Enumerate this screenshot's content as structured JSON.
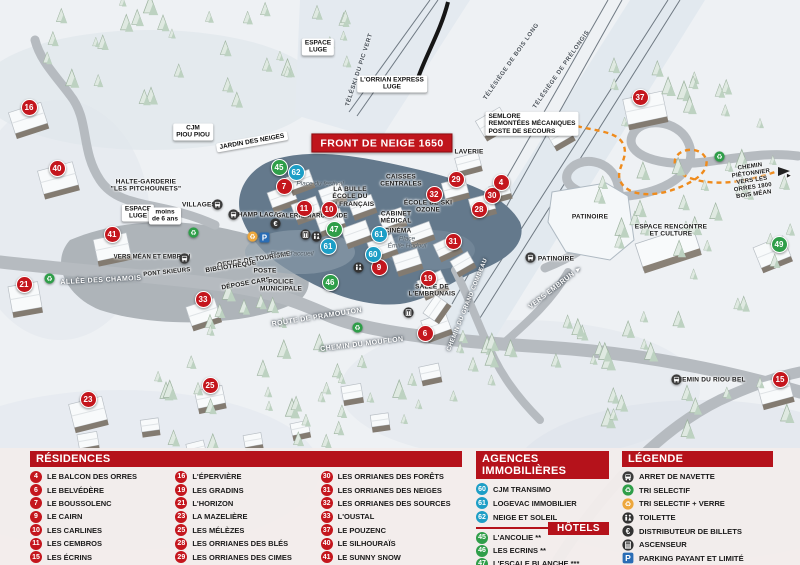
{
  "title": "FRONT DE NEIGE 1650",
  "colors": {
    "residence": "#c4161d",
    "agency": "#1d9ec6",
    "hotel": "#2f9e49",
    "header_red": "#b5121b",
    "parking_blue": "#2a6db5",
    "path_orange": "#ef8b1c"
  },
  "legend": {
    "residences": {
      "header": "RÉSIDENCES",
      "items": [
        {
          "num": "4",
          "label": "LE BALCON DES ORRES"
        },
        {
          "num": "6",
          "label": "LE BELVÉDÈRE"
        },
        {
          "num": "7",
          "label": "LE BOUSSOLENC"
        },
        {
          "num": "9",
          "label": "LE CAIRN"
        },
        {
          "num": "10",
          "label": "LES CARLINES"
        },
        {
          "num": "11",
          "label": "LES CEMBROS"
        },
        {
          "num": "15",
          "label": "LES ÉCRINS"
        },
        {
          "num": "16",
          "label": "L'ÉPERVIÈRE"
        },
        {
          "num": "19",
          "label": "LES GRADINS"
        },
        {
          "num": "21",
          "label": "L'HORIZON"
        },
        {
          "num": "23",
          "label": "LA MAZELIÈRE"
        },
        {
          "num": "25",
          "label": "LES MÉLÈZES"
        },
        {
          "num": "28",
          "label": "LES ORRIANES DES BLÉS"
        },
        {
          "num": "29",
          "label": "LES ORRIANES DES CIMES"
        },
        {
          "num": "30",
          "label": "LES ORRIANES DES FORÊTS"
        },
        {
          "num": "31",
          "label": "LES ORRIANES DES NEIGES"
        },
        {
          "num": "32",
          "label": "LES ORRIANES DES SOURCES"
        },
        {
          "num": "33",
          "label": "L'OUSTAL"
        },
        {
          "num": "37",
          "label": "LE POUZENC"
        },
        {
          "num": "40",
          "label": "LE SILHOURAÏS"
        },
        {
          "num": "41",
          "label": "LE SUNNY SNOW"
        }
      ]
    },
    "agences": {
      "header": "AGENCES IMMOBILIÈRES",
      "items": [
        {
          "num": "60",
          "label": "CJM TRANSIMO"
        },
        {
          "num": "61",
          "label": "LOGEVAC IMMOBILIER"
        },
        {
          "num": "62",
          "label": "NEIGE ET SOLEIL"
        }
      ]
    },
    "hotels": {
      "header": "HÔTELS",
      "items": [
        {
          "num": "45",
          "label": "L'ANCOLIE **"
        },
        {
          "num": "46",
          "label": "LES ECRINS **"
        },
        {
          "num": "47",
          "label": "L'ESCALE BLANCHE ***"
        },
        {
          "num": "49",
          "label": "LES TRAPPEURS **"
        }
      ]
    },
    "legende": {
      "header": "LÉGENDE",
      "items": [
        {
          "icon": "bus",
          "label": "ARRET DE NAVETTE"
        },
        {
          "icon": "recycle",
          "label": "TRI SELECTIF"
        },
        {
          "icon": "recycle-verre",
          "label": "TRI SELECTIF + VERRE"
        },
        {
          "icon": "toilet",
          "label": "TOILETTE"
        },
        {
          "icon": "euro",
          "label": "DISTRIBUTEUR DE BILLETS"
        },
        {
          "icon": "elevator",
          "label": "ASCENSEUR"
        },
        {
          "icon": "parking",
          "label": "PARKING PAYANT ET LIMITÉ"
        }
      ]
    }
  },
  "map": {
    "markers": [
      {
        "num": "16",
        "type": "residence",
        "x": 28,
        "y": 106
      },
      {
        "num": "40",
        "type": "residence",
        "x": 56,
        "y": 167
      },
      {
        "num": "41",
        "type": "residence",
        "x": 111,
        "y": 233
      },
      {
        "num": "21",
        "type": "residence",
        "x": 23,
        "y": 283
      },
      {
        "num": "33",
        "type": "residence",
        "x": 202,
        "y": 298
      },
      {
        "num": "23",
        "type": "residence",
        "x": 87,
        "y": 398
      },
      {
        "num": "25",
        "type": "residence",
        "x": 209,
        "y": 384
      },
      {
        "num": "7",
        "type": "residence",
        "x": 283,
        "y": 185
      },
      {
        "num": "11",
        "type": "residence",
        "x": 303,
        "y": 207
      },
      {
        "num": "10",
        "type": "residence",
        "x": 328,
        "y": 208
      },
      {
        "num": "9",
        "type": "residence",
        "x": 378,
        "y": 266
      },
      {
        "num": "19",
        "type": "residence",
        "x": 427,
        "y": 277
      },
      {
        "num": "6",
        "type": "residence",
        "x": 424,
        "y": 332
      },
      {
        "num": "31",
        "type": "residence",
        "x": 452,
        "y": 240
      },
      {
        "num": "32",
        "type": "residence",
        "x": 433,
        "y": 193
      },
      {
        "num": "29",
        "type": "residence",
        "x": 455,
        "y": 178
      },
      {
        "num": "30",
        "type": "residence",
        "x": 491,
        "y": 194
      },
      {
        "num": "28",
        "type": "residence",
        "x": 478,
        "y": 208
      },
      {
        "num": "4",
        "type": "residence",
        "x": 500,
        "y": 181
      },
      {
        "num": "37",
        "type": "residence",
        "x": 639,
        "y": 96
      },
      {
        "num": "15",
        "type": "residence",
        "x": 779,
        "y": 378
      },
      {
        "num": "45",
        "type": "hotel",
        "x": 278,
        "y": 166
      },
      {
        "num": "47",
        "type": "hotel",
        "x": 333,
        "y": 228
      },
      {
        "num": "46",
        "type": "hotel",
        "x": 329,
        "y": 281
      },
      {
        "num": "49",
        "type": "hotel",
        "x": 778,
        "y": 243
      },
      {
        "num": "62",
        "type": "agency",
        "x": 295,
        "y": 171
      },
      {
        "num": "61",
        "type": "agency",
        "x": 327,
        "y": 245
      },
      {
        "num": "61",
        "type": "agency",
        "x": 378,
        "y": 233
      },
      {
        "num": "60",
        "type": "agency",
        "x": 372,
        "y": 253
      }
    ],
    "icons": [
      {
        "icon": "bus",
        "x": 217,
        "y": 204
      },
      {
        "icon": "bus",
        "x": 233,
        "y": 214
      },
      {
        "icon": "bus",
        "x": 184,
        "y": 258
      },
      {
        "icon": "bus",
        "x": 530,
        "y": 257
      },
      {
        "icon": "bus",
        "x": 676,
        "y": 379
      },
      {
        "icon": "recycle",
        "x": 49,
        "y": 278
      },
      {
        "icon": "recycle",
        "x": 193,
        "y": 232
      },
      {
        "icon": "recycle",
        "x": 357,
        "y": 327
      },
      {
        "icon": "recycle",
        "x": 719,
        "y": 156
      },
      {
        "icon": "recycle-verre",
        "x": 252,
        "y": 236
      },
      {
        "icon": "parking",
        "x": 264,
        "y": 237
      },
      {
        "icon": "euro",
        "x": 275,
        "y": 223
      },
      {
        "icon": "elevator",
        "x": 305,
        "y": 234
      },
      {
        "icon": "elevator",
        "x": 408,
        "y": 312
      },
      {
        "icon": "toilet",
        "x": 316,
        "y": 236
      },
      {
        "icon": "toilet",
        "x": 358,
        "y": 267
      }
    ],
    "labels": [
      {
        "text": "FRONT DE NEIGE 1650",
        "x": 382,
        "y": 143,
        "cls": "red"
      },
      {
        "text": "L'ORRIAN EXPRESS\nLUGE",
        "x": 392,
        "y": 84,
        "cls": "box"
      },
      {
        "text": "ESPACE\nLUGE",
        "x": 318,
        "y": 47,
        "cls": "box"
      },
      {
        "text": "TÉLÉSKI DU PIC VERT",
        "x": 360,
        "y": 70,
        "cls": "lift",
        "rot": -72
      },
      {
        "text": "TÉLÉSIÈGE DE BOIS LONG",
        "x": 512,
        "y": 62,
        "cls": "lift",
        "rot": -55
      },
      {
        "text": "TÉLÉSIÈGE DE PRÉLONGIS",
        "x": 562,
        "y": 70,
        "cls": "lift",
        "rot": -55
      },
      {
        "text": "SEMLORE\nREMONTÉES MÉCANIQUES\nPOSTE DE SECOURS",
        "x": 532,
        "y": 124,
        "cls": "box",
        "align": "left"
      },
      {
        "text": "CJM\nPIOU PIOU",
        "x": 193,
        "y": 132,
        "cls": "box"
      },
      {
        "text": "JARDIN DES NEIGES",
        "x": 252,
        "y": 142,
        "cls": "box",
        "rot": -10
      },
      {
        "text": "HALTE-GARDERIE\n\"LES PITCHOUNETS\"",
        "x": 146,
        "y": 186,
        "cls": "dark"
      },
      {
        "text": "ESPACE\nLUGE",
        "x": 138,
        "y": 213,
        "cls": "box"
      },
      {
        "text": "moins\nde 6 ans",
        "x": 165,
        "y": 216,
        "cls": "box"
      },
      {
        "text": "VILLAGES",
        "x": 199,
        "y": 205,
        "cls": "dark"
      },
      {
        "text": "CHAMP LACAS",
        "x": 258,
        "y": 215,
        "cls": "dark"
      },
      {
        "text": "GALERIE MARCHANDE",
        "x": 312,
        "y": 217,
        "cls": "dark",
        "fs": 6
      },
      {
        "text": "LA BULLE\nÉCOLE DU\nSKI FRANÇAIS",
        "x": 350,
        "y": 197,
        "cls": "dark"
      },
      {
        "text": "Place du festival",
        "x": 320,
        "y": 184,
        "cls": "ital"
      },
      {
        "text": "CAISSES\nCENTRALES",
        "x": 401,
        "y": 181,
        "cls": "dark"
      },
      {
        "text": "LAVERIE",
        "x": 469,
        "y": 152,
        "cls": "dark"
      },
      {
        "text": "ÉCOLE DE SKI\nOZONE",
        "x": 428,
        "y": 207,
        "cls": "dark"
      },
      {
        "text": "CABINET\nMÉDICAL",
        "x": 396,
        "y": 218,
        "cls": "dark"
      },
      {
        "text": "CINÉMA",
        "x": 398,
        "y": 231,
        "cls": "dark"
      },
      {
        "text": "Place\nÉmile Hodoul",
        "x": 407,
        "y": 243,
        "cls": "ital"
      },
      {
        "text": "OFFICE DE TOURISME",
        "x": 254,
        "y": 260,
        "cls": "dark",
        "rot": -9
      },
      {
        "text": "BIBLIOTHÈQUE",
        "x": 231,
        "y": 267,
        "cls": "dark",
        "rot": -9
      },
      {
        "text": "POSTE",
        "x": 265,
        "y": 271,
        "cls": "dark"
      },
      {
        "text": "DÉPOSE CARS",
        "x": 246,
        "y": 284,
        "cls": "dark",
        "rot": -10
      },
      {
        "text": "POLICE\nMUNICIPALE",
        "x": 281,
        "y": 286,
        "cls": "dark"
      },
      {
        "text": "SALLE DE\nL'EMBRUNAIS",
        "x": 432,
        "y": 291,
        "cls": "dark"
      },
      {
        "text": "Place d'accueil",
        "x": 292,
        "y": 254,
        "cls": "ital"
      },
      {
        "text": "ALLÉE DES CHAMOIS",
        "x": 101,
        "y": 281,
        "cls": "white",
        "rot": -3
      },
      {
        "text": "VERS MÉAN ET EMBRUN",
        "x": 152,
        "y": 258,
        "cls": "dark",
        "fs": 6
      },
      {
        "text": "PONT SKIEURS",
        "x": 167,
        "y": 273,
        "cls": "dark",
        "fs": 6,
        "rot": -6
      },
      {
        "text": "ROUTE DE PRAMOUTON",
        "x": 317,
        "y": 318,
        "cls": "white",
        "rot": -9
      },
      {
        "text": "CHEMIN DU MOUFLON",
        "x": 362,
        "y": 345,
        "cls": "white",
        "rot": -7
      },
      {
        "text": "CHEMIN DU GRAND COMBEAU",
        "x": 468,
        "y": 305,
        "cls": "white",
        "rot": -68,
        "fs": 6
      },
      {
        "text": "PATINOIRE",
        "x": 590,
        "y": 217,
        "cls": "dark"
      },
      {
        "text": "PATINOIRE",
        "x": 556,
        "y": 259,
        "cls": "dark"
      },
      {
        "text": "VERS EMBRUN ►",
        "x": 556,
        "y": 288,
        "cls": "white",
        "rot": -38
      },
      {
        "text": "ESPACE RENCONTRE\nET CULTURE",
        "x": 671,
        "y": 231,
        "cls": "dark"
      },
      {
        "text": "CHEMIN DU RIOU BEL",
        "x": 709,
        "y": 380,
        "cls": "dark"
      },
      {
        "text": "CHEMIN PIÉTONNIER\nVERS LES ORRES 1800\nBOIS MÉAN",
        "x": 752,
        "y": 181,
        "cls": "dark",
        "rot": -8,
        "fs": 6
      },
      {
        "text": "►",
        "x": 789,
        "y": 176,
        "cls": "dark"
      }
    ]
  }
}
